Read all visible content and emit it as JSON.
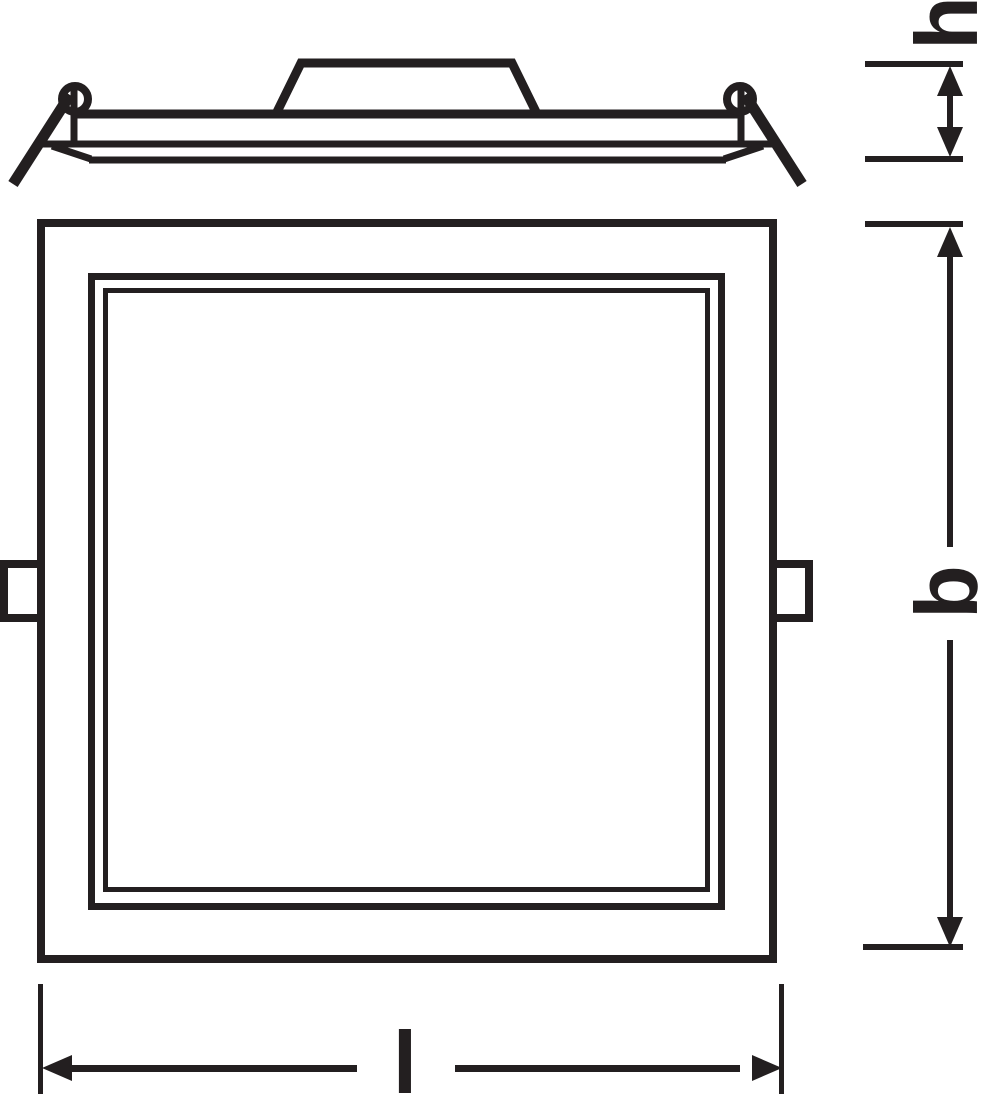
{
  "drawing": {
    "dimensions": {
      "h": {
        "label": "h"
      },
      "b": {
        "label": "b"
      },
      "l": {
        "label": "l"
      }
    },
    "colors": {
      "line": "#231f20",
      "background": "#ffffff"
    }
  }
}
